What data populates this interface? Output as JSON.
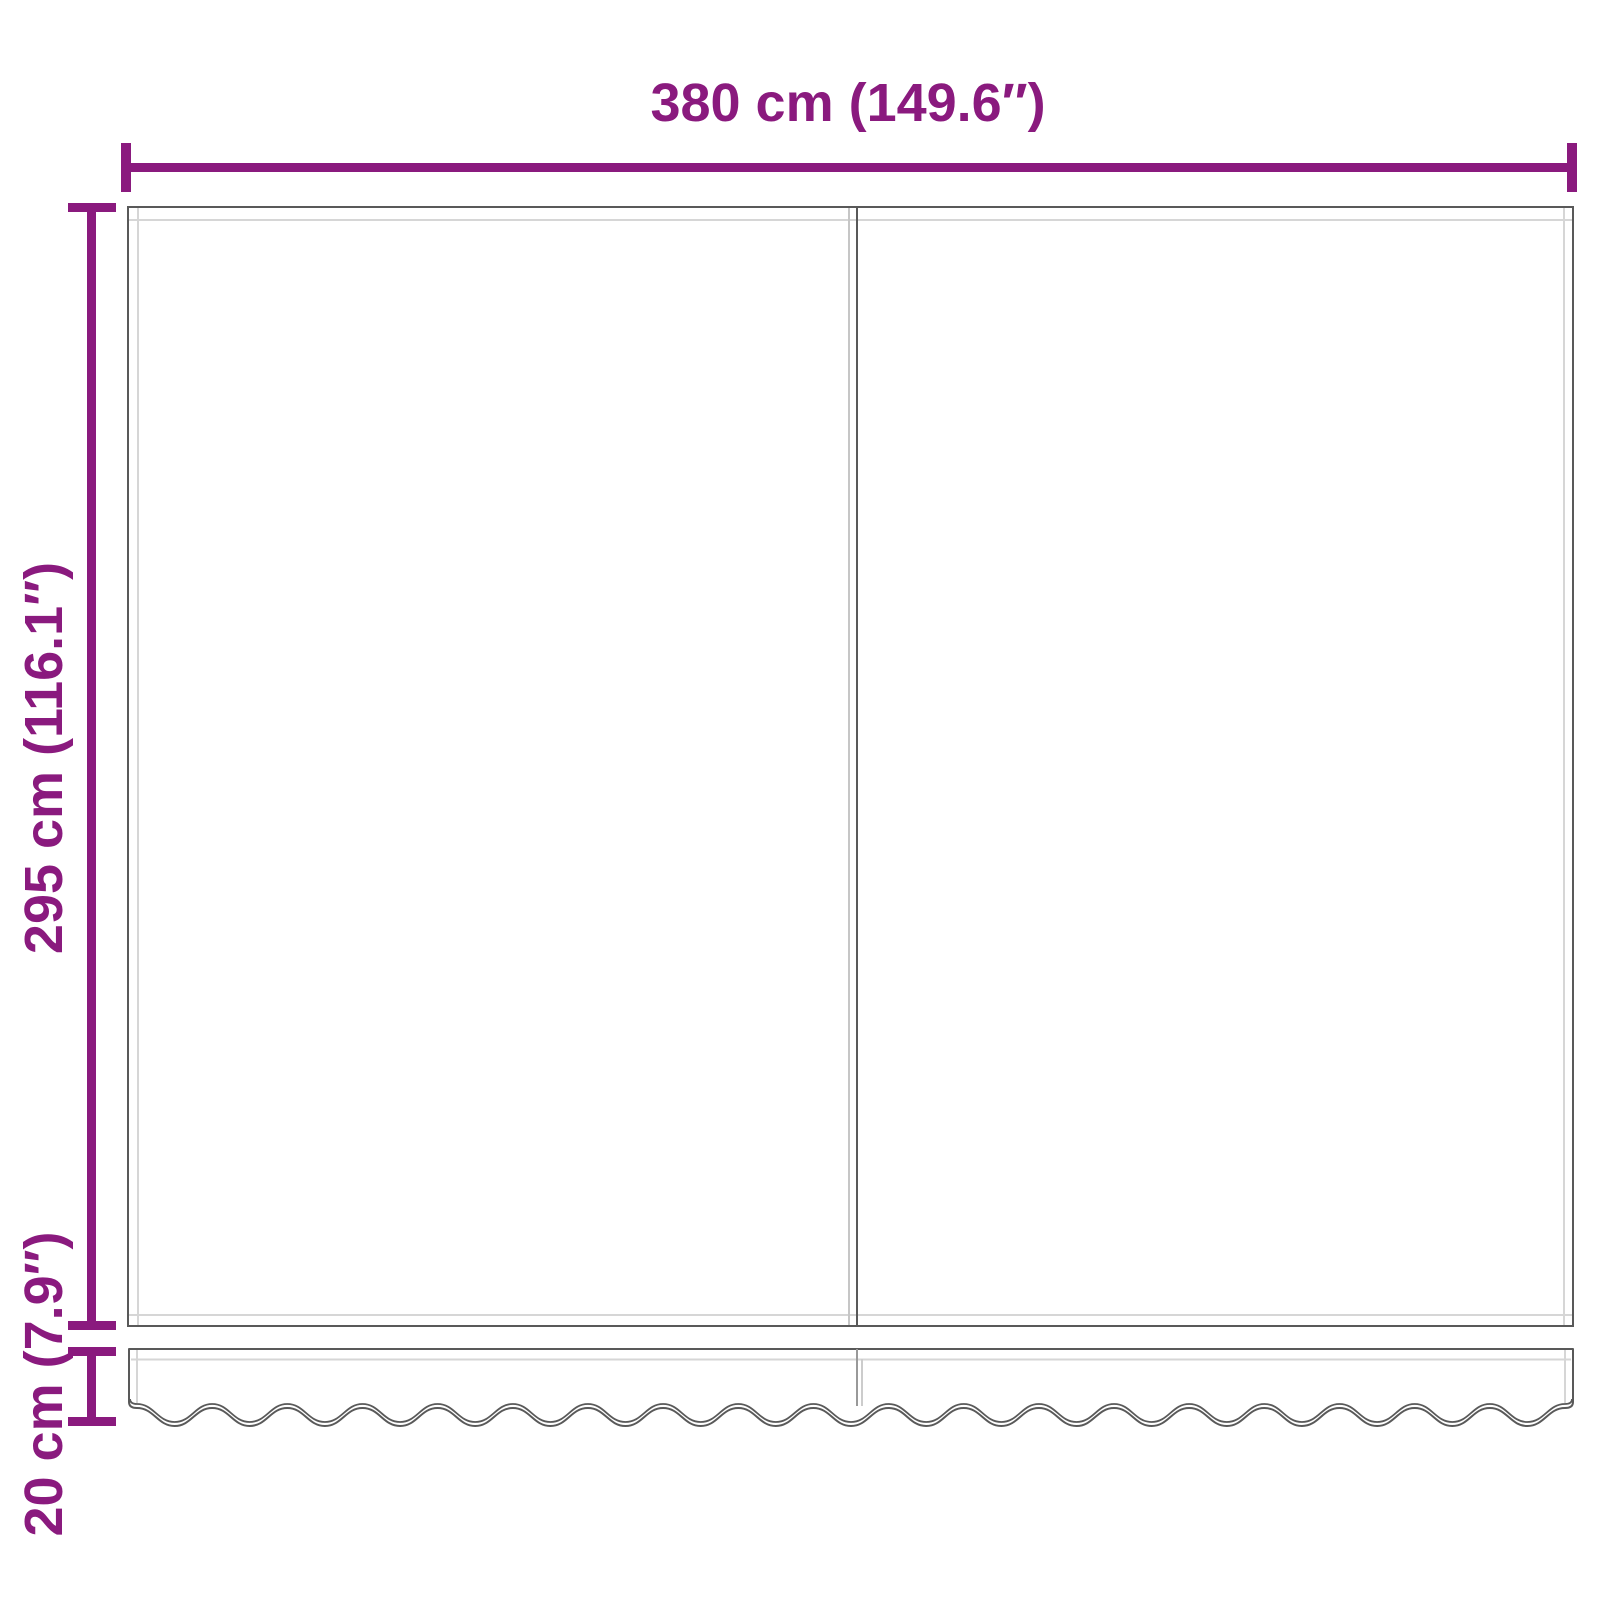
{
  "diagram": {
    "type": "product-dimension-diagram",
    "subject": "awning-replacement-fabric-with-valance",
    "dimensions": {
      "width_label": "380 cm (149.6″)",
      "height_label": "295 cm (116.1″)",
      "valance_label": "20 cm (7.9″)"
    },
    "colors": {
      "dimension": "#8a1a7e",
      "outline": "#595959",
      "hem": "#d6d6d6",
      "seam_light": "#c6c6c6",
      "background": "#ffffff"
    }
  }
}
